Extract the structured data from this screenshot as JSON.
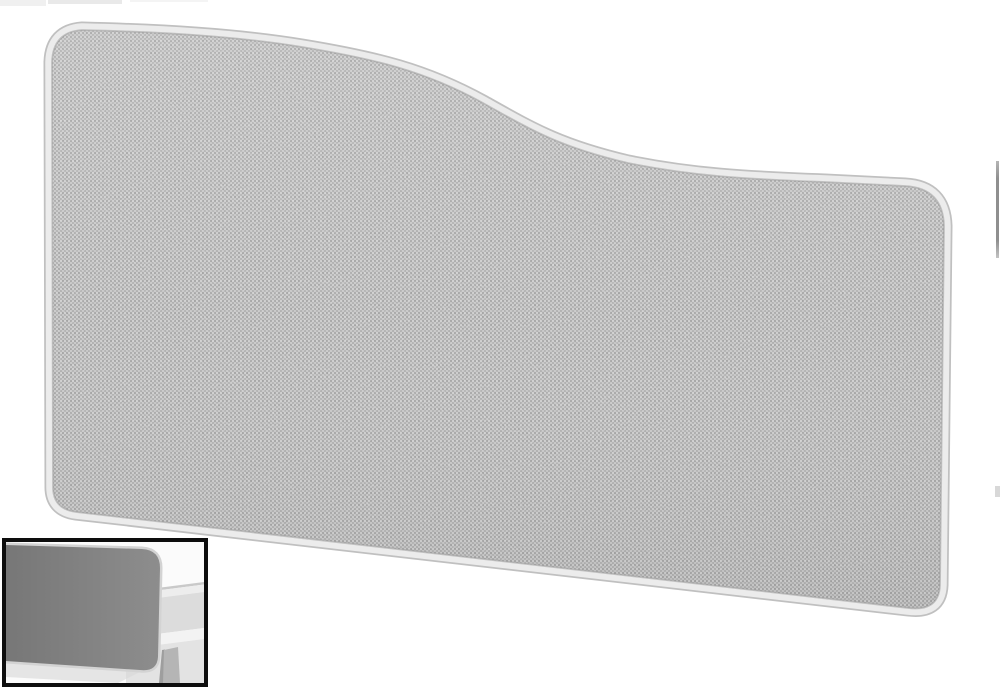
{
  "page": {
    "background": "#ffffff",
    "description": "Product photo of a wave-top acoustic desk screen upholstered in light grey woven fabric with a pale grey rounded frame; small inset photo bottom-left shows the grey screen mounted on the back of a white desk"
  },
  "product": {
    "name": "wave-top-desk-screen-light-grey-fabric",
    "fabric_base": "#b6b6b6",
    "fabric_weave_light": "#ffffff",
    "fabric_weave_dark": "#000000",
    "trim_light": "#ececec",
    "trim_outline": "#c0c0c0",
    "groove": "#979797"
  },
  "inset": {
    "name": "screen-mounted-on-desk-photo",
    "border": "#0d0d0d",
    "background": "#fbfbfb",
    "panel_dark": "#777777",
    "panel_light": "#8d8d8d",
    "panel_trim": "#d3d3d3",
    "desk_top": "#ededed",
    "desk_top_edge": "#c9c9c9",
    "under_desk": "#dcdcdc",
    "front_band": "#f3f3f3",
    "below_desk": "#e3e3e3",
    "leg": "#b5b5b5",
    "leg_shade": "#9e9e9e",
    "floor_shadow": "#d9d9d9"
  },
  "artifacts": {
    "top_fragment_a": "#f0f0f0",
    "top_fragment_b": "#e9e9e9",
    "top_fragment_c": "#f4f4f4",
    "right_sliver": "#8f8f8f",
    "right_sliver_small": "#d8d8d8"
  }
}
